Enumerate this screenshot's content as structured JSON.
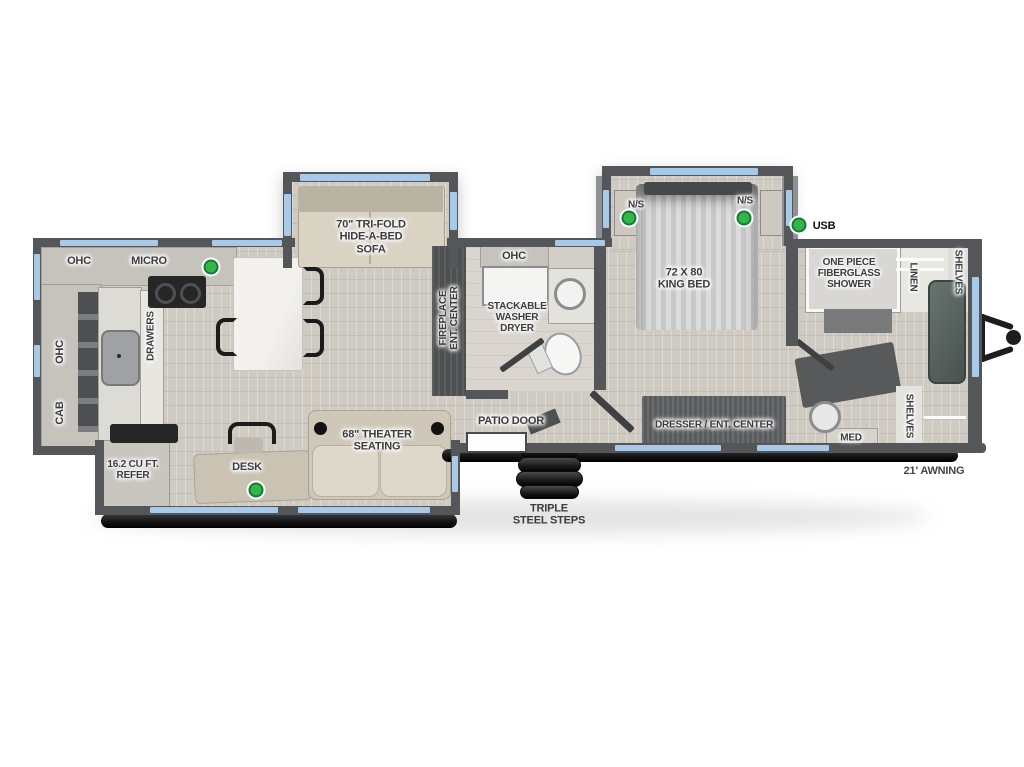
{
  "labels": {
    "ohc_rear": "OHC",
    "micro": "MICRO",
    "ohc_side": "OHC",
    "cab_side": "CAB",
    "drawers": "DRAWERS",
    "refer": "16.2 CU FT.\nREFER",
    "desk": "DESK",
    "theater": "68\" THEATER\nSEATING",
    "sofa": "70\" TRI-FOLD\nHIDE-A-BED\nSOFA",
    "fireplace": "FIREPLACE\nENT. CENTER",
    "ohc_bath": "OHC",
    "washer": "STACKABLE\nWASHER\nDRYER",
    "patio_door": "PATIO DOOR",
    "steps": "TRIPLE\nSTEEL STEPS",
    "ns_left": "N/S",
    "ns_right": "N/S",
    "king_bed": "72 X 80\nKING BED",
    "usb": "USB",
    "dresser": "DRESSER / ENT. CENTER",
    "shower": "ONE PIECE\nFIBERGLASS\nSHOWER",
    "linen": "LINEN",
    "shelves_top": "SHELVES",
    "shelves_bottom": "SHELVES",
    "med": "MED",
    "awning": "21' AWNING"
  },
  "colors": {
    "wall": "#545659",
    "wall_light": "#8e9093",
    "window_blue": "#a9c9e8",
    "floor_wood": "#cfcbc2",
    "indicator_green": "#35b44a"
  }
}
